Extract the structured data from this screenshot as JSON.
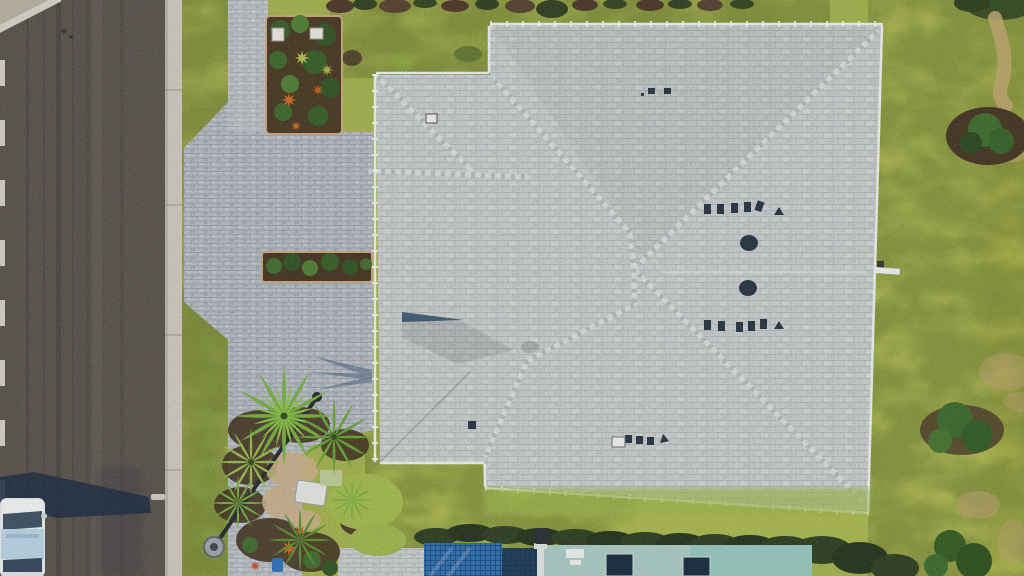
{
  "alt": "Aerial drone photo of a single-family house with a light gray tile hip roof, paver driveway, asphalt street on the left, yellow-green lawn, palm trees, a street lamp, a parked car, and a pool with teal lanai at the bottom.",
  "palette": {
    "road": "#58504a",
    "roadEdge": "#d5cfc2",
    "curb": "#cec8bc",
    "cornerConcrete": "#b7b0a4",
    "grass": "#a3b14c",
    "grassOlive": "#8d9c43",
    "grassBright": "#b9c457",
    "grassDark": "#55742f",
    "paver": "#b4bac1",
    "paverLight": "#c8ccc9",
    "roof": "#c9cccd",
    "ridge": "#d9dcdc",
    "gutter": "#eef0ee",
    "mulch": "#43331f",
    "bedEdge": "#c9a67b",
    "foliage": "#3f6b2c",
    "foliageDark": "#2f3d1f",
    "hedge": "#2b3d1e",
    "palmBright": "#74b03e",
    "palmMid": "#65a336",
    "palmYellow": "#96bb4d",
    "palmDark": "#578f2f",
    "pool": "#2b6fb2",
    "spa": "#1d3a58",
    "deck": "#a9cac3",
    "skylight": "#15293d",
    "sand": "#c9ae86",
    "dirt": "#b9a06a",
    "vent": "#253240",
    "white": "#eef0ee",
    "carBody": "#e9ecec",
    "carRoof": "#b9d3e3",
    "carGlass": "#3c4f60",
    "shadow": "#1b2a40",
    "palmShadow": "#3e5a78",
    "lampPole": "#23282e",
    "lampBase": "#9ba3aa",
    "orange": "#cd6a1f",
    "blueObject": "#2d6fbe"
  }
}
